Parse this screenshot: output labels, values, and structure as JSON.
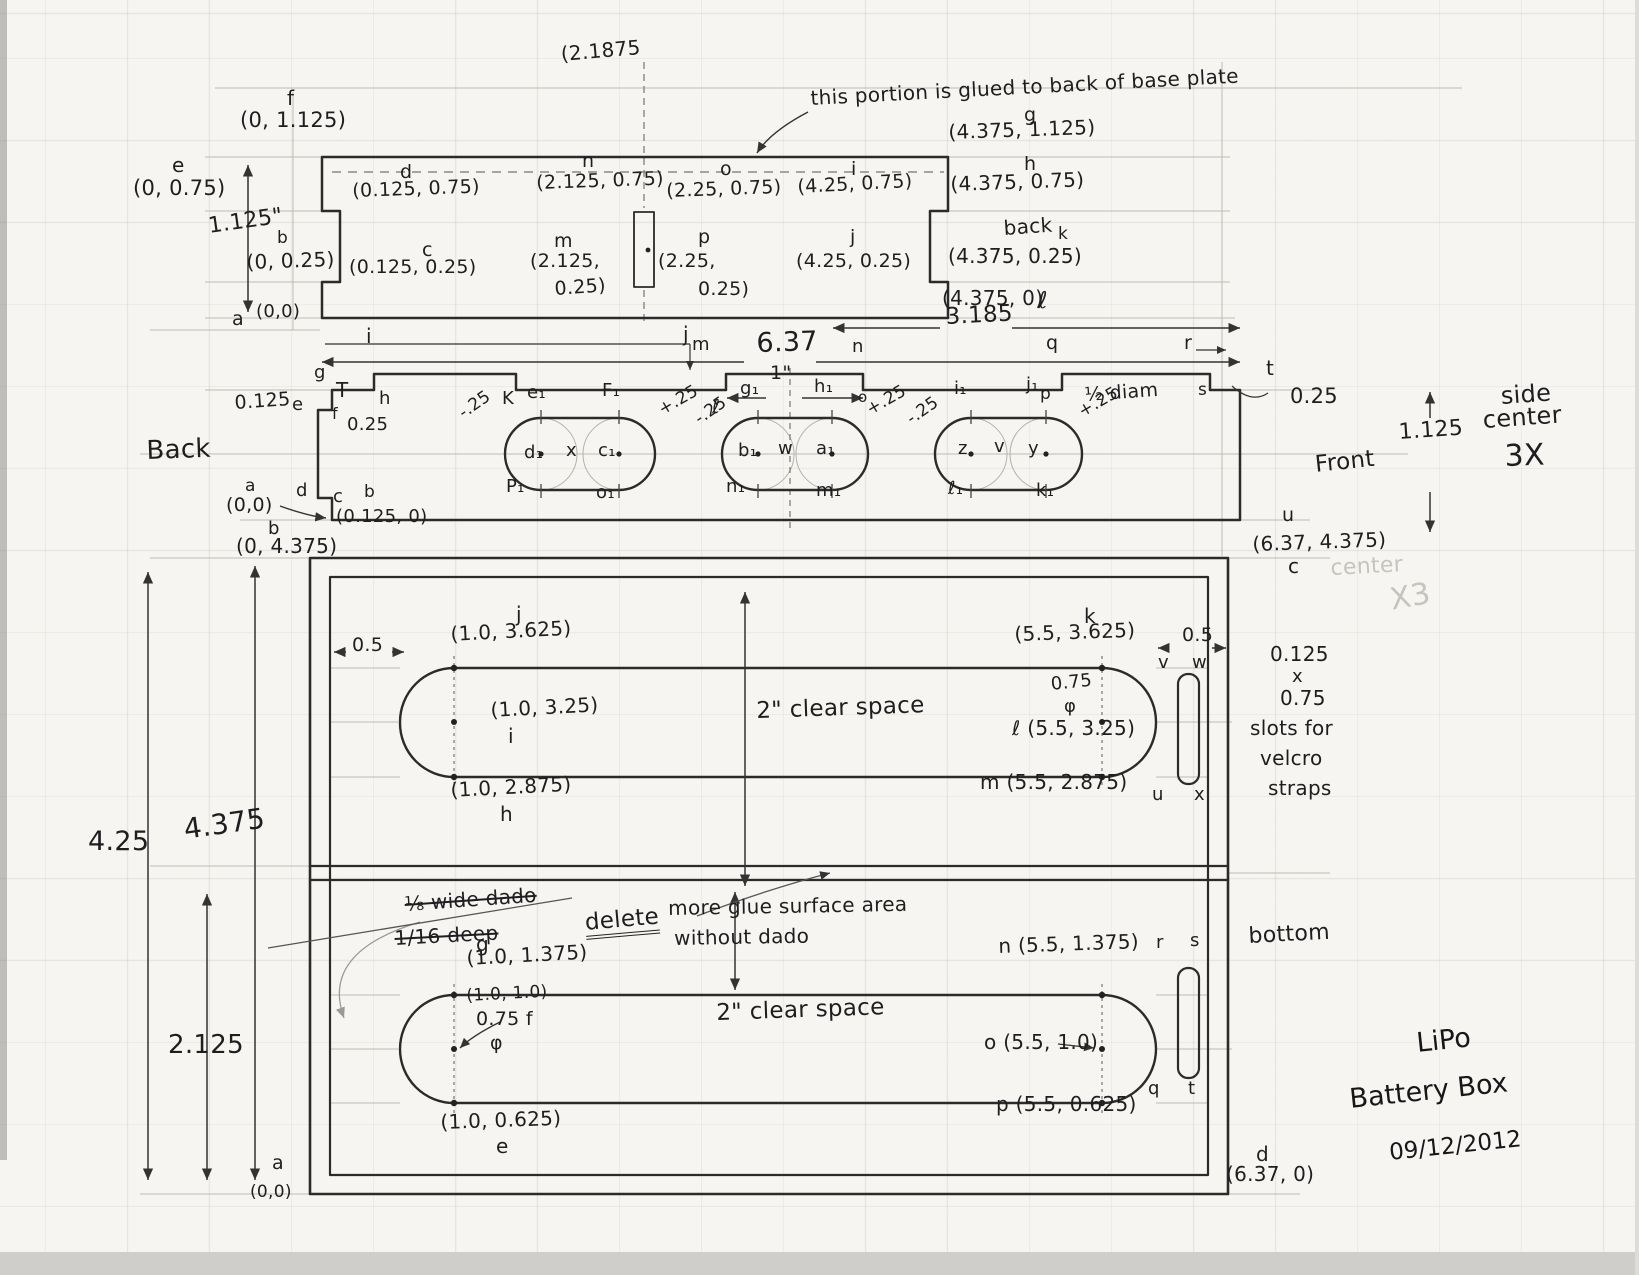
{
  "page": {
    "paper_color": "#f6f5f1",
    "pencil_color": "#2b2b2b",
    "guide_color": "#b9b5ad",
    "description": "Hand-drawn pencil engineering sketch of a LiPo battery box with three views: top plate, side-center piece (3X), and bottom plate"
  },
  "title_block": {
    "line1": "LiPo",
    "line2": "Battery Box",
    "date": "09/12/2012"
  },
  "views": {
    "top_view": {
      "note": "this portion is glued to back of base plate",
      "height_dim": "1.125\"",
      "centerline_x": "(2.1875"
    },
    "side_view": {
      "caption": "side center 3X",
      "left_label": "Back",
      "right_label": "Front",
      "width_dim": "6.37",
      "half_width_dim": "3.185",
      "tab_dim": "1\"",
      "slot_note": "½ diam"
    },
    "bottom_view": {
      "caption": "bottom",
      "clear_space": "2\" clear space",
      "velcro_note": "0.125 x 0.75 slots for velcro straps",
      "height_dims": [
        "4.25",
        "4.375",
        "2.125"
      ],
      "deleted_note": "⅛ wide dado 1/16 deep",
      "revision_note": "delete — more glue surface area without dado"
    }
  },
  "labels": [
    {
      "n": "top-centerline-coord",
      "t": "(2.1875",
      "x": 560,
      "y": 44,
      "s": 20,
      "r": -5
    },
    {
      "n": "pt-f",
      "t": "f",
      "x": 287,
      "y": 88,
      "s": 20
    },
    {
      "n": "coord-f",
      "t": "(0, 1.125)",
      "x": 240,
      "y": 110,
      "s": 21
    },
    {
      "n": "pt-e",
      "t": "e",
      "x": 172,
      "y": 155,
      "s": 20
    },
    {
      "n": "coord-e",
      "t": "(0, 0.75)",
      "x": 133,
      "y": 178,
      "s": 21
    },
    {
      "n": "dim-height-top-view",
      "t": "1.125\"",
      "x": 207,
      "y": 216,
      "s": 22,
      "r": -8
    },
    {
      "n": "pt-b",
      "t": "b",
      "x": 277,
      "y": 230,
      "s": 17
    },
    {
      "n": "coord-b",
      "t": "(0, 0.25)",
      "x": 246,
      "y": 252,
      "s": 20,
      "r": -2
    },
    {
      "n": "pt-a",
      "t": "a",
      "x": 232,
      "y": 310,
      "s": 19
    },
    {
      "n": "coord-a",
      "t": "(0,0)",
      "x": 256,
      "y": 303,
      "s": 18
    },
    {
      "n": "pt-d",
      "t": "d",
      "x": 400,
      "y": 163,
      "s": 19
    },
    {
      "n": "coord-d",
      "t": "(0.125, 0.75)",
      "x": 352,
      "y": 182,
      "s": 19,
      "r": -2
    },
    {
      "n": "pt-c",
      "t": "c",
      "x": 422,
      "y": 241,
      "s": 19
    },
    {
      "n": "coord-c",
      "t": "(0.125, 0.25)",
      "x": 349,
      "y": 258,
      "s": 19
    },
    {
      "n": "pt-n",
      "t": "n",
      "x": 582,
      "y": 152,
      "s": 19
    },
    {
      "n": "coord-n",
      "t": "(2.125, 0.75)",
      "x": 536,
      "y": 174,
      "s": 19,
      "r": -2
    },
    {
      "n": "pt-m",
      "t": "m",
      "x": 554,
      "y": 232,
      "s": 19
    },
    {
      "n": "coord-m-line1",
      "t": "(2.125,",
      "x": 530,
      "y": 252,
      "s": 19
    },
    {
      "n": "coord-m-line2",
      "t": "0.25)",
      "x": 554,
      "y": 280,
      "s": 19,
      "r": -4
    },
    {
      "n": "pt-o",
      "t": "o",
      "x": 720,
      "y": 160,
      "s": 19
    },
    {
      "n": "coord-o",
      "t": "(2.25, 0.75)",
      "x": 666,
      "y": 182,
      "s": 19,
      "r": -2
    },
    {
      "n": "pt-p",
      "t": "p",
      "x": 698,
      "y": 228,
      "s": 19
    },
    {
      "n": "coord-p-line1",
      "t": "(2.25,",
      "x": 658,
      "y": 252,
      "s": 19
    },
    {
      "n": "coord-p-line2",
      "t": "0.25)",
      "x": 698,
      "y": 280,
      "s": 19
    },
    {
      "n": "pt-i",
      "t": "i",
      "x": 851,
      "y": 160,
      "s": 19
    },
    {
      "n": "coord-i",
      "t": "(4.25, 0.75)",
      "x": 797,
      "y": 178,
      "s": 19,
      "r": -3
    },
    {
      "n": "pt-j",
      "t": "j",
      "x": 850,
      "y": 228,
      "s": 19
    },
    {
      "n": "coord-j",
      "t": "(4.25, 0.25)",
      "x": 796,
      "y": 252,
      "s": 19
    },
    {
      "n": "pt-g",
      "t": "g",
      "x": 1024,
      "y": 106,
      "s": 19
    },
    {
      "n": "coord-g",
      "t": "(4.375, 1.125)",
      "x": 948,
      "y": 122,
      "s": 20,
      "r": -2
    },
    {
      "n": "pt-h",
      "t": "h",
      "x": 1024,
      "y": 155,
      "s": 19
    },
    {
      "n": "coord-h",
      "t": "(4.375, 0.75)",
      "x": 950,
      "y": 174,
      "s": 20,
      "r": -2
    },
    {
      "n": "back-note",
      "t": "back",
      "x": 1003,
      "y": 218,
      "s": 20,
      "r": -4
    },
    {
      "n": "pt-k",
      "t": "k",
      "x": 1058,
      "y": 226,
      "s": 17
    },
    {
      "n": "coord-k",
      "t": "(4.375, 0.25)",
      "x": 948,
      "y": 246,
      "s": 20
    },
    {
      "n": "coord-l",
      "t": "(4.375, 0)",
      "x": 942,
      "y": 288,
      "s": 20
    },
    {
      "n": "pt-l",
      "t": "ℓ",
      "x": 1038,
      "y": 290,
      "s": 23
    },
    {
      "n": "glue-note",
      "t": "this portion is glued to back of base plate",
      "x": 810,
      "y": 88,
      "s": 20,
      "r": -3
    },
    {
      "n": "dim-3185",
      "t": "3.185",
      "x": 945,
      "y": 306,
      "s": 23,
      "r": -3
    },
    {
      "n": "dim-637",
      "t": "6.37",
      "x": 756,
      "y": 330,
      "s": 27,
      "r": -2
    },
    {
      "n": "dim-1in",
      "t": "1\"",
      "x": 770,
      "y": 364,
      "s": 19
    },
    {
      "n": "sv-pt-i",
      "t": "i",
      "x": 366,
      "y": 326,
      "s": 20
    },
    {
      "n": "sv-pt-j",
      "t": "j",
      "x": 683,
      "y": 324,
      "s": 20
    },
    {
      "n": "sv-pt-m",
      "t": "m",
      "x": 692,
      "y": 336,
      "s": 18
    },
    {
      "n": "sv-pt-n",
      "t": "n",
      "x": 852,
      "y": 338,
      "s": 18
    },
    {
      "n": "sv-pt-q",
      "t": "q",
      "x": 1046,
      "y": 334,
      "s": 19
    },
    {
      "n": "sv-pt-r",
      "t": "r",
      "x": 1184,
      "y": 334,
      "s": 19
    },
    {
      "n": "sv-pt-g",
      "t": "g",
      "x": 314,
      "y": 364,
      "s": 18
    },
    {
      "n": "sv-pt-h",
      "t": "h",
      "x": 379,
      "y": 390,
      "s": 18
    },
    {
      "n": "sv-pt-K",
      "t": "K",
      "x": 502,
      "y": 390,
      "s": 18
    },
    {
      "n": "sv-tick-T",
      "t": "T",
      "x": 336,
      "y": 380,
      "s": 20
    },
    {
      "n": "sv-pt-e",
      "t": "e",
      "x": 292,
      "y": 396,
      "s": 18
    },
    {
      "n": "sv-dim-0125",
      "t": "0.125",
      "x": 234,
      "y": 394,
      "s": 19,
      "r": -4
    },
    {
      "n": "sv-pt-f",
      "t": "f",
      "x": 332,
      "y": 406,
      "s": 16
    },
    {
      "n": "sv-dim-025-left",
      "t": "0.25",
      "x": 347,
      "y": 416,
      "s": 18
    },
    {
      "n": "sv-pt-d",
      "t": "d",
      "x": 296,
      "y": 482,
      "s": 18
    },
    {
      "n": "sv-pt-c",
      "t": "c",
      "x": 333,
      "y": 488,
      "s": 18
    },
    {
      "n": "sv-pt-a",
      "t": "a",
      "x": 245,
      "y": 478,
      "s": 17
    },
    {
      "n": "sv-coord-a",
      "t": "(0,0)",
      "x": 226,
      "y": 496,
      "s": 19
    },
    {
      "n": "sv-pt-b",
      "t": "b",
      "x": 364,
      "y": 484,
      "s": 17
    },
    {
      "n": "sv-coord-b",
      "t": "(0.125, 0)",
      "x": 336,
      "y": 508,
      "s": 18
    },
    {
      "n": "back-label",
      "t": "Back",
      "x": 146,
      "y": 438,
      "s": 26,
      "r": -2
    },
    {
      "n": "sv-pt-l",
      "t": "ℓ",
      "x": 712,
      "y": 398,
      "s": 19
    },
    {
      "n": "sv-pt-o",
      "t": "o",
      "x": 858,
      "y": 390,
      "s": 15
    },
    {
      "n": "sv-pt-p",
      "t": "p",
      "x": 1040,
      "y": 386,
      "s": 17
    },
    {
      "n": "sv-pt-s",
      "t": "s",
      "x": 1198,
      "y": 382,
      "s": 17
    },
    {
      "n": "sv-pt-t",
      "t": "t",
      "x": 1266,
      "y": 358,
      "s": 20
    },
    {
      "n": "sv-dim-025-right",
      "t": "0.25",
      "x": 1290,
      "y": 386,
      "s": 21
    },
    {
      "n": "half-diam-note",
      "t": "½ diam",
      "x": 1084,
      "y": 386,
      "s": 19,
      "r": -4
    },
    {
      "n": "sv-pt-u",
      "t": "u",
      "x": 1282,
      "y": 506,
      "s": 19
    },
    {
      "n": "front-label",
      "t": "Front",
      "x": 1314,
      "y": 454,
      "s": 23,
      "r": -6
    },
    {
      "n": "sv-dim-1125",
      "t": "1.125",
      "x": 1398,
      "y": 422,
      "s": 22,
      "r": -4
    },
    {
      "n": "side-caption-1",
      "t": "side",
      "x": 1500,
      "y": 384,
      "s": 24,
      "r": -4
    },
    {
      "n": "side-caption-2",
      "t": "center",
      "x": 1482,
      "y": 408,
      "s": 24,
      "r": -4
    },
    {
      "n": "side-caption-3",
      "t": "3X",
      "x": 1504,
      "y": 442,
      "s": 30,
      "r": -2
    },
    {
      "n": "s1-e1",
      "t": "e₁",
      "x": 527,
      "y": 384,
      "s": 18
    },
    {
      "n": "s1-f1",
      "t": "F₁",
      "x": 602,
      "y": 382,
      "s": 18
    },
    {
      "n": "s1-d1",
      "t": "d₁",
      "x": 524,
      "y": 444,
      "s": 18
    },
    {
      "n": "s1-x",
      "t": "x",
      "x": 566,
      "y": 442,
      "s": 18
    },
    {
      "n": "s1-c1",
      "t": "c₁",
      "x": 598,
      "y": 442,
      "s": 18
    },
    {
      "n": "s1-p1",
      "t": "P₁",
      "x": 506,
      "y": 478,
      "s": 18
    },
    {
      "n": "s1-o1",
      "t": "o₁",
      "x": 596,
      "y": 484,
      "s": 18
    },
    {
      "n": "s1-minus25",
      "t": "-.25",
      "x": 456,
      "y": 408,
      "s": 17,
      "r": -35
    },
    {
      "n": "s1-plus25",
      "t": "+.25",
      "x": 656,
      "y": 404,
      "s": 17,
      "r": -30
    },
    {
      "n": "s2-g1",
      "t": "g₁",
      "x": 740,
      "y": 380,
      "s": 18
    },
    {
      "n": "s2-h1",
      "t": "h₁",
      "x": 814,
      "y": 378,
      "s": 18
    },
    {
      "n": "s2-b1",
      "t": "b₁",
      "x": 738,
      "y": 442,
      "s": 18
    },
    {
      "n": "s2-w",
      "t": "w",
      "x": 778,
      "y": 440,
      "s": 18
    },
    {
      "n": "s2-a1",
      "t": "a₁",
      "x": 816,
      "y": 440,
      "s": 18
    },
    {
      "n": "s2-n1",
      "t": "n₁",
      "x": 726,
      "y": 478,
      "s": 18
    },
    {
      "n": "s2-m1",
      "t": "m₁",
      "x": 816,
      "y": 482,
      "s": 18
    },
    {
      "n": "s2-minus25",
      "t": "-.25",
      "x": 692,
      "y": 414,
      "s": 17,
      "r": -35
    },
    {
      "n": "s2-plus25",
      "t": "+.25",
      "x": 864,
      "y": 404,
      "s": 17,
      "r": -30
    },
    {
      "n": "s3-i1",
      "t": "i₁",
      "x": 954,
      "y": 380,
      "s": 18
    },
    {
      "n": "s3-j1",
      "t": "j₁",
      "x": 1026,
      "y": 376,
      "s": 18
    },
    {
      "n": "s3-z",
      "t": "z",
      "x": 958,
      "y": 440,
      "s": 18
    },
    {
      "n": "s3-v",
      "t": "v",
      "x": 994,
      "y": 438,
      "s": 18
    },
    {
      "n": "s3-y",
      "t": "y",
      "x": 1028,
      "y": 440,
      "s": 18
    },
    {
      "n": "s3-l1",
      "t": "ℓ₁",
      "x": 948,
      "y": 480,
      "s": 18
    },
    {
      "n": "s3-k1",
      "t": "k₁",
      "x": 1036,
      "y": 482,
      "s": 18
    },
    {
      "n": "s3-minus25",
      "t": "-.25",
      "x": 904,
      "y": 414,
      "s": 17,
      "r": -35
    },
    {
      "n": "s3-plus25",
      "t": "+.25",
      "x": 1076,
      "y": 406,
      "s": 17,
      "r": -30
    },
    {
      "n": "bv-pt-b",
      "t": "b",
      "x": 268,
      "y": 520,
      "s": 18
    },
    {
      "n": "bv-coord-b",
      "t": "(0, 4.375)",
      "x": 236,
      "y": 536,
      "s": 20
    },
    {
      "n": "bv-coord-c",
      "t": "(6.37, 4.375)",
      "x": 1252,
      "y": 534,
      "s": 20,
      "r": -2
    },
    {
      "n": "bv-pt-c",
      "t": "c",
      "x": 1288,
      "y": 556,
      "s": 20
    },
    {
      "n": "ghost-center",
      "t": "center",
      "x": 1330,
      "y": 558,
      "s": 22,
      "r": -3,
      "c": "faint"
    },
    {
      "n": "ghost-x3",
      "t": "X3",
      "x": 1388,
      "y": 586,
      "s": 30,
      "r": -10,
      "c": "faint"
    },
    {
      "n": "bv-dim-05-left",
      "t": "0.5",
      "x": 352,
      "y": 636,
      "s": 19
    },
    {
      "n": "bv-pt-j",
      "t": "j",
      "x": 516,
      "y": 604,
      "s": 20
    },
    {
      "n": "bv-coord-j",
      "t": "(1.0, 3.625)",
      "x": 450,
      "y": 624,
      "s": 20,
      "r": -3
    },
    {
      "n": "bv-coord-i",
      "t": "(1.0, 3.25)",
      "x": 490,
      "y": 700,
      "s": 20,
      "r": -3
    },
    {
      "n": "bv-pt-i",
      "t": "i",
      "x": 508,
      "y": 726,
      "s": 20
    },
    {
      "n": "bv-coord-h",
      "t": "(1.0, 2.875)",
      "x": 450,
      "y": 780,
      "s": 20,
      "r": -3
    },
    {
      "n": "bv-pt-h",
      "t": "h",
      "x": 500,
      "y": 804,
      "s": 20
    },
    {
      "n": "bv-pt-k",
      "t": "k",
      "x": 1084,
      "y": 606,
      "s": 20
    },
    {
      "n": "bv-coord-k",
      "t": "(5.5, 3.625)",
      "x": 1014,
      "y": 624,
      "s": 20,
      "r": -2
    },
    {
      "n": "bv-dim-075",
      "t": "0.75",
      "x": 1050,
      "y": 676,
      "s": 18,
      "r": -6
    },
    {
      "n": "bv-phi-upper",
      "t": "φ",
      "x": 1064,
      "y": 698,
      "s": 18
    },
    {
      "n": "bv-coord-l",
      "t": "ℓ (5.5, 3.25)",
      "x": 1012,
      "y": 718,
      "s": 20
    },
    {
      "n": "bv-coord-m",
      "t": "m (5.5, 2.875)",
      "x": 980,
      "y": 772,
      "s": 20
    },
    {
      "n": "bv-dim-05-right",
      "t": "0.5",
      "x": 1182,
      "y": 626,
      "s": 19
    },
    {
      "n": "bv-pt-v",
      "t": "v",
      "x": 1158,
      "y": 654,
      "s": 18
    },
    {
      "n": "bv-pt-w",
      "t": "w",
      "x": 1192,
      "y": 654,
      "s": 18
    },
    {
      "n": "bv-pt-u",
      "t": "u",
      "x": 1152,
      "y": 786,
      "s": 18
    },
    {
      "n": "bv-pt-x",
      "t": "x",
      "x": 1194,
      "y": 786,
      "s": 18
    },
    {
      "n": "velcro-note-1",
      "t": "0.125",
      "x": 1270,
      "y": 644,
      "s": 20
    },
    {
      "n": "velcro-note-2",
      "t": "x",
      "x": 1292,
      "y": 668,
      "s": 18
    },
    {
      "n": "velcro-note-3",
      "t": "0.75",
      "x": 1280,
      "y": 688,
      "s": 20
    },
    {
      "n": "velcro-note-4",
      "t": "slots for",
      "x": 1250,
      "y": 718,
      "s": 20
    },
    {
      "n": "velcro-note-5",
      "t": "velcro",
      "x": 1260,
      "y": 748,
      "s": 20
    },
    {
      "n": "velcro-note-6",
      "t": "straps",
      "x": 1268,
      "y": 778,
      "s": 20
    },
    {
      "n": "clear-space-upper",
      "t": "2\" clear space",
      "x": 756,
      "y": 700,
      "s": 23,
      "r": -2
    },
    {
      "n": "dim-425",
      "t": "4.25",
      "x": 88,
      "y": 828,
      "s": 27
    },
    {
      "n": "dim-4375",
      "t": "4.375",
      "x": 182,
      "y": 816,
      "s": 28,
      "r": -8
    },
    {
      "n": "dim-2125",
      "t": "2.125",
      "x": 168,
      "y": 1032,
      "s": 26
    },
    {
      "n": "strike-note-1",
      "t": "⅛ wide dado",
      "x": 404,
      "y": 894,
      "s": 20,
      "r": -4,
      "c": "strike"
    },
    {
      "n": "strike-note-2",
      "t": "1/16 deep",
      "x": 394,
      "y": 928,
      "s": 20,
      "r": -3,
      "c": "strike"
    },
    {
      "n": "bv-pt-g",
      "t": "g",
      "x": 476,
      "y": 934,
      "s": 20
    },
    {
      "n": "delete-note",
      "t": "delete",
      "x": 584,
      "y": 912,
      "s": 23,
      "r": -5,
      "c": "underline2"
    },
    {
      "n": "glue-area-note-1",
      "t": "more glue surface area",
      "x": 668,
      "y": 898,
      "s": 20,
      "r": -1
    },
    {
      "n": "glue-area-note-2",
      "t": "without dado",
      "x": 674,
      "y": 928,
      "s": 20,
      "r": -1
    },
    {
      "n": "bv-coord-g",
      "t": "(1.0, 1.375)",
      "x": 466,
      "y": 948,
      "s": 20,
      "r": -3
    },
    {
      "n": "bv-coord-f",
      "t": "(1.0, 1.0)",
      "x": 466,
      "y": 988,
      "s": 17,
      "r": -3
    },
    {
      "n": "bv-dim-075-f",
      "t": "0.75 f",
      "x": 476,
      "y": 1010,
      "s": 19
    },
    {
      "n": "bv-phi-lower",
      "t": "φ",
      "x": 490,
      "y": 1034,
      "s": 19
    },
    {
      "n": "bv-coord-e",
      "t": "(1.0, 0.625)",
      "x": 440,
      "y": 1112,
      "s": 20,
      "r": -2
    },
    {
      "n": "bv-pt-e",
      "t": "e",
      "x": 496,
      "y": 1136,
      "s": 20
    },
    {
      "n": "clear-space-lower",
      "t": "2\" clear space",
      "x": 716,
      "y": 1002,
      "s": 23,
      "r": -2
    },
    {
      "n": "bv-coord-n",
      "t": "n (5.5, 1.375)",
      "x": 998,
      "y": 936,
      "s": 20,
      "r": -2
    },
    {
      "n": "bv-coord-o",
      "t": "o (5.5, 1.0)",
      "x": 984,
      "y": 1032,
      "s": 20
    },
    {
      "n": "bv-coord-p",
      "t": "p (5.5, 0.625)",
      "x": 996,
      "y": 1094,
      "s": 20
    },
    {
      "n": "bv-pt-r",
      "t": "r",
      "x": 1156,
      "y": 934,
      "s": 18
    },
    {
      "n": "bv-pt-s",
      "t": "s",
      "x": 1190,
      "y": 932,
      "s": 18
    },
    {
      "n": "bv-pt-q",
      "t": "q",
      "x": 1148,
      "y": 1080,
      "s": 18
    },
    {
      "n": "bv-pt-t",
      "t": "t",
      "x": 1188,
      "y": 1080,
      "s": 18
    },
    {
      "n": "bottom-label",
      "t": "bottom",
      "x": 1248,
      "y": 926,
      "s": 22,
      "r": -3
    },
    {
      "n": "bv-pt-d",
      "t": "d",
      "x": 1256,
      "y": 1144,
      "s": 20
    },
    {
      "n": "bv-coord-d",
      "t": "(6.37, 0)",
      "x": 1226,
      "y": 1164,
      "s": 20
    },
    {
      "n": "bv-pt-a",
      "t": "a",
      "x": 272,
      "y": 1154,
      "s": 19
    },
    {
      "n": "bv-coord-a",
      "t": "(0,0)",
      "x": 250,
      "y": 1184,
      "s": 17
    }
  ]
}
